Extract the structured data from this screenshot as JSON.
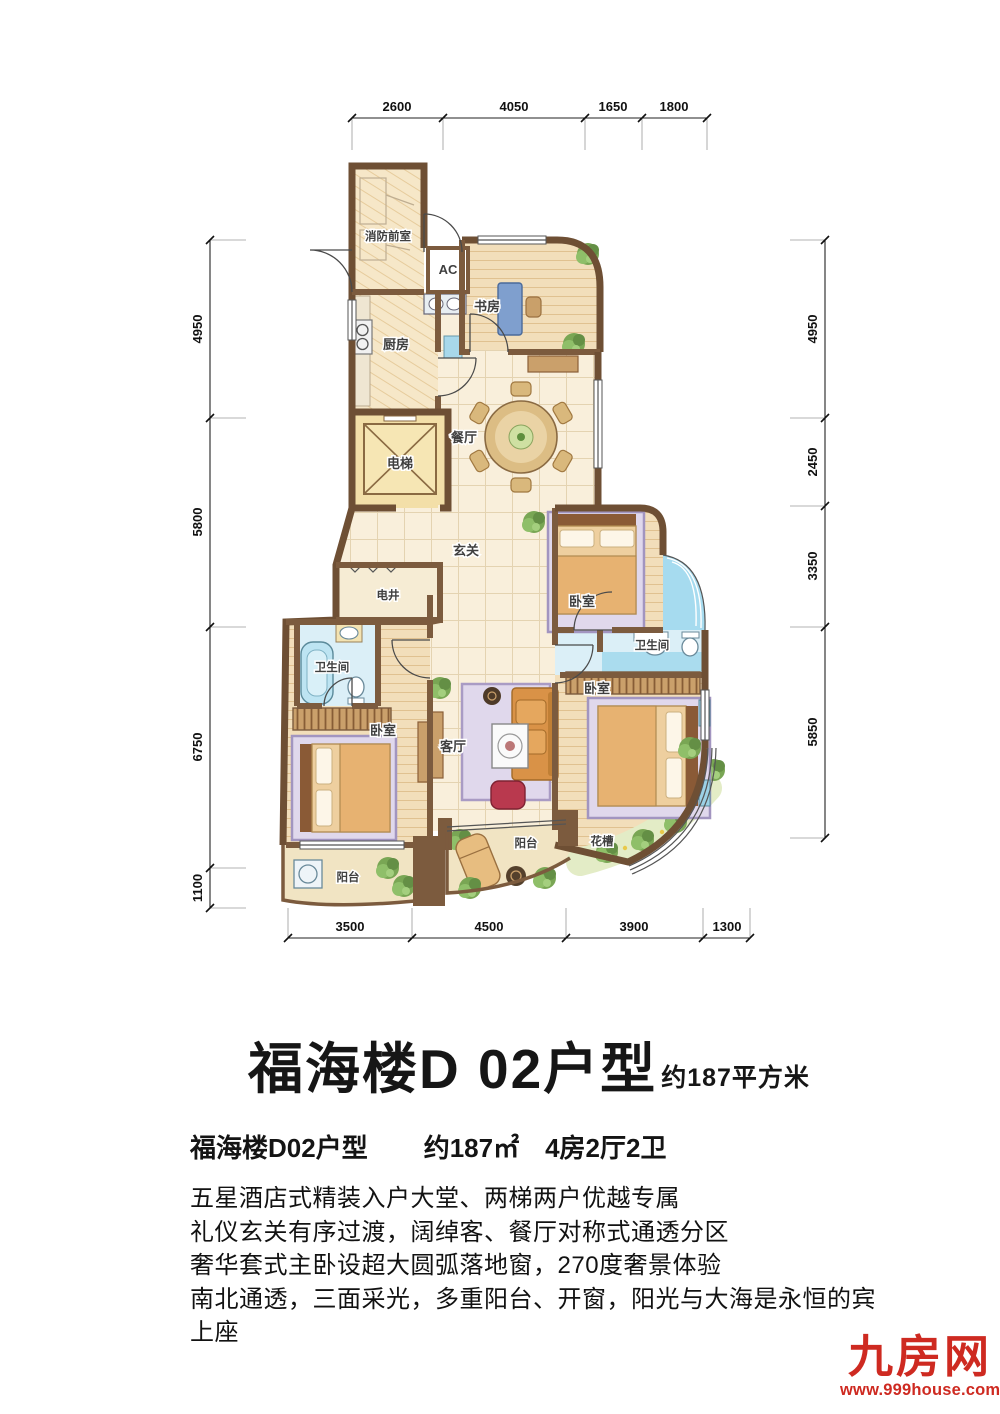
{
  "plan": {
    "rooms": {
      "fire_lobby": "消防前室",
      "ac": "AC",
      "kitchen": "厨房",
      "study": "书房",
      "dining": "餐厅",
      "elevator": "电梯",
      "hall": "玄关",
      "shaft": "电井",
      "bath_left": "卫生间",
      "bath_right": "卫生间",
      "bedroom_left": "卧室",
      "bedroom_top": "卧室",
      "bedroom_master": "卧室",
      "living": "客厅",
      "balcony_left": "阳台",
      "balcony_main": "阳台",
      "planter": "花槽"
    },
    "dims": {
      "top": [
        "2600",
        "4050",
        "1650",
        "1800"
      ],
      "left": [
        "4950",
        "5800",
        "6750",
        "1100"
      ],
      "right": [
        "4950",
        "2450",
        "3350",
        "5850"
      ],
      "bottom": [
        "3500",
        "4500",
        "3900",
        "1300"
      ]
    }
  },
  "title": {
    "main": "福海楼D 02户型",
    "area_suffix": "约187平方米"
  },
  "summary": {
    "name": "福海楼D02户型",
    "area": "约187㎡",
    "layout": "4房2厅2卫"
  },
  "description": {
    "lines": [
      "五星酒店式精装入户大堂、两梯两户优越专属",
      "礼仪玄关有序过渡，阔绰客、餐厅对称式通透分区",
      "奢华套式主卧设超大圆弧落地窗，270度奢景体验",
      "南北通透，三面采光，多重阳台、开窗，阳光与大海是永恒的宾",
      "上座"
    ]
  },
  "logo": {
    "name": "九房网",
    "url": "www.999house.com",
    "color": "#ce2a21"
  }
}
